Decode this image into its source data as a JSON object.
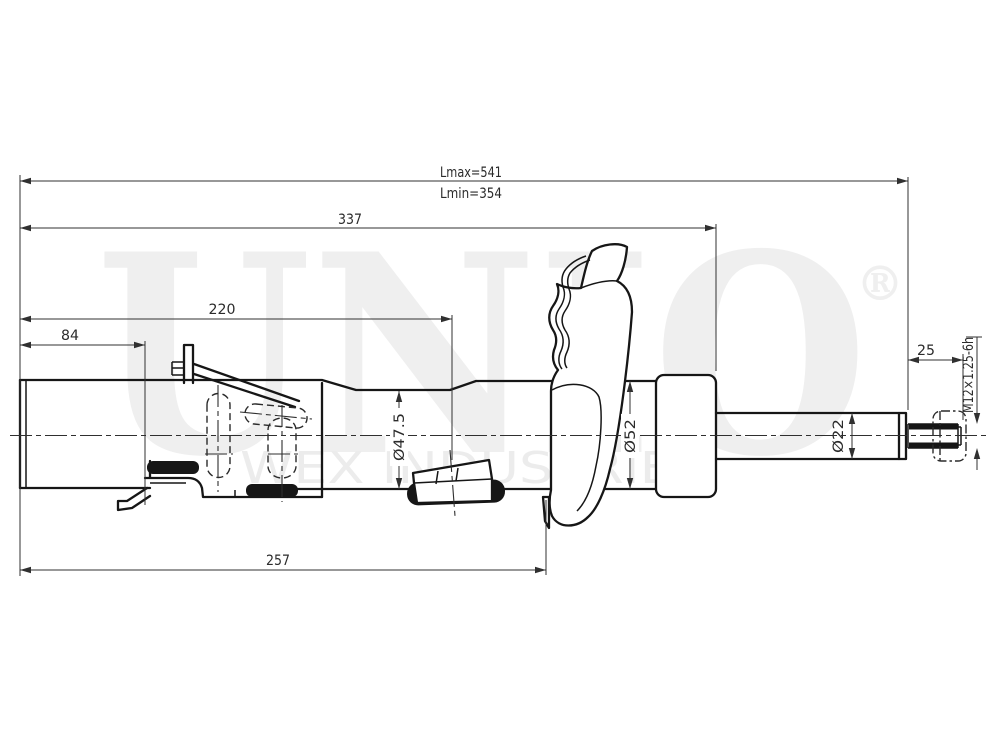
{
  "watermark": {
    "brand": "UNIO",
    "registered": "®",
    "subtitle": "WEX INDUSTRIES"
  },
  "dimensions": {
    "length_max": "Lmax=541",
    "length_min": "Lmin=354",
    "len_337": "337",
    "len_220": "220",
    "len_84": "84",
    "len_257": "257",
    "thread_len_25": "25",
    "dia_body": "Ø47.5",
    "dia_collar": "Ø52",
    "dia_rod": "Ø22",
    "thread_spec": "M12×1.25-6h"
  },
  "colors": {
    "line": "#161616",
    "dimension": "#303030",
    "watermark": "#efefef",
    "background": "#ffffff"
  }
}
